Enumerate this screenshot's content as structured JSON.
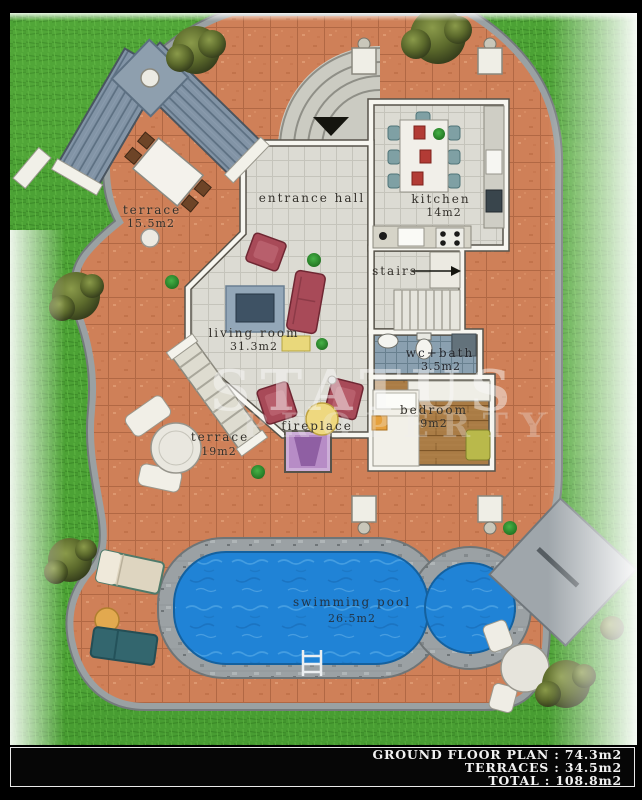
{
  "watermark": {
    "brand": "STATUS",
    "brand2": "PROPERTY"
  },
  "rooms": {
    "entrance_hall": {
      "label": "entrance hall"
    },
    "kitchen": {
      "label": "kitchen",
      "area": "14m2"
    },
    "stairs": {
      "label": "stairs"
    },
    "living_room": {
      "label": "living room",
      "area": "31.3m2"
    },
    "wc_bath": {
      "label": "wc+bath",
      "area": "3.5m2"
    },
    "bedroom": {
      "label": "bedroom",
      "area": "9m2"
    },
    "fireplace": {
      "label": "fireplace"
    }
  },
  "outdoor": {
    "terrace_upper": {
      "label": "terrace",
      "area": "15.5m2"
    },
    "terrace_lower": {
      "label": "terrace",
      "area": "19m2"
    },
    "swimming_pool": {
      "label": "swimming pool",
      "area": "26.5m2"
    }
  },
  "summary": {
    "lines": [
      "GROUND FLOOR PLAN : 74.3m2",
      "TERRACES : 34.5m2",
      "TOTAL : 108.8m2"
    ]
  },
  "colors": {
    "grass": "#4ca235",
    "terracotta": "#cf8058",
    "pool_water": "#2083d6",
    "stone": "#9ba1a4",
    "wall": "#f7f6f0",
    "sofa": "#a84a58",
    "frame": "#000000"
  }
}
